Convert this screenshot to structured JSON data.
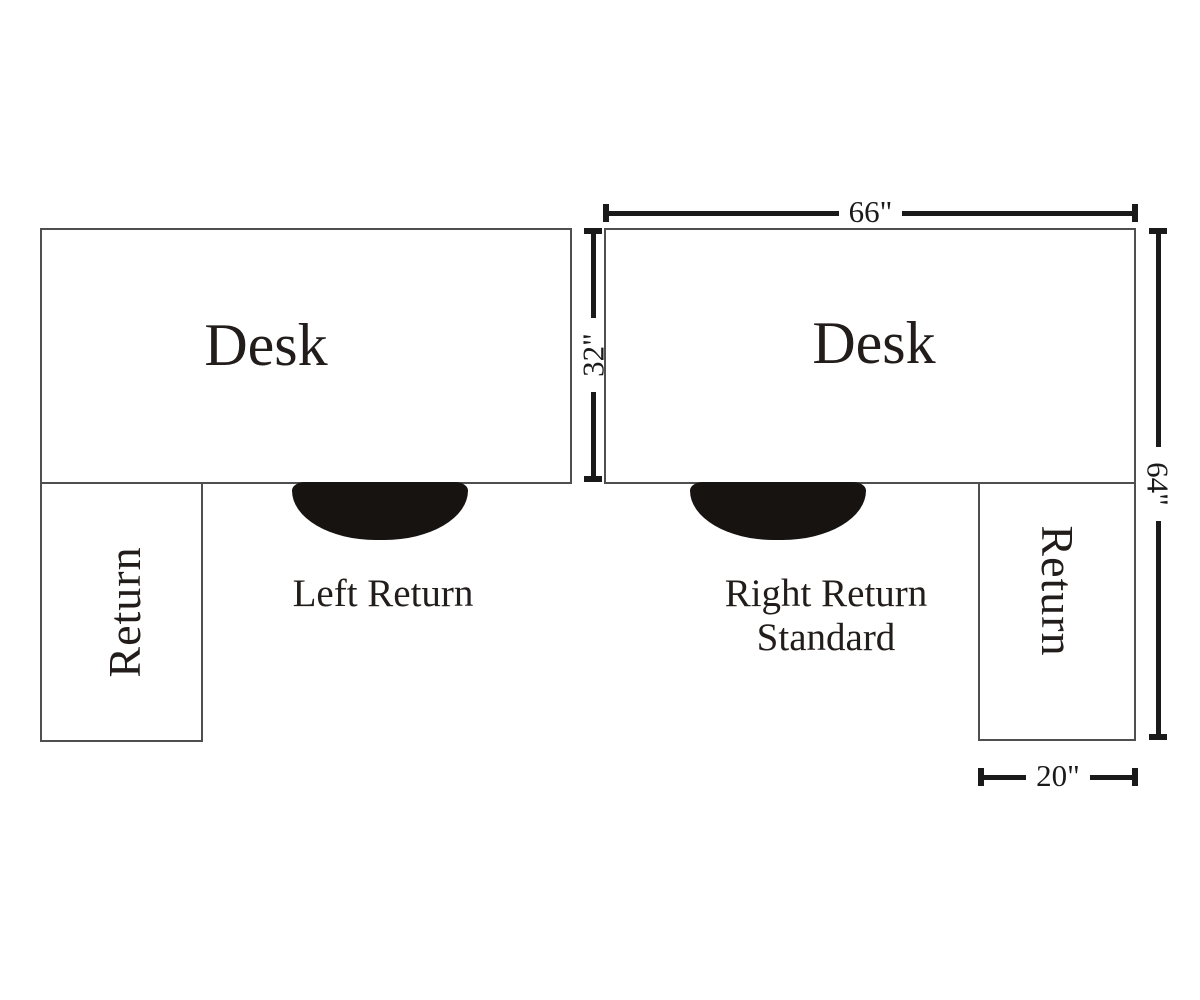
{
  "left_config": {
    "desk_label": "Desk",
    "return_label": "Return",
    "caption": "Left Return"
  },
  "right_config": {
    "desk_label": "Desk",
    "return_label": "Return",
    "caption_line1": "Right Return",
    "caption_line2": "Standard"
  },
  "dimensions": {
    "desk_width": "66\"",
    "desk_depth": "32\"",
    "total_depth": "64\"",
    "return_width": "20\""
  },
  "colors": {
    "background": "#ffffff",
    "box_border": "#4f4f4f",
    "dimension_line": "#1a1a1a",
    "text": "#221d1b",
    "chair_fill": "#171310"
  }
}
